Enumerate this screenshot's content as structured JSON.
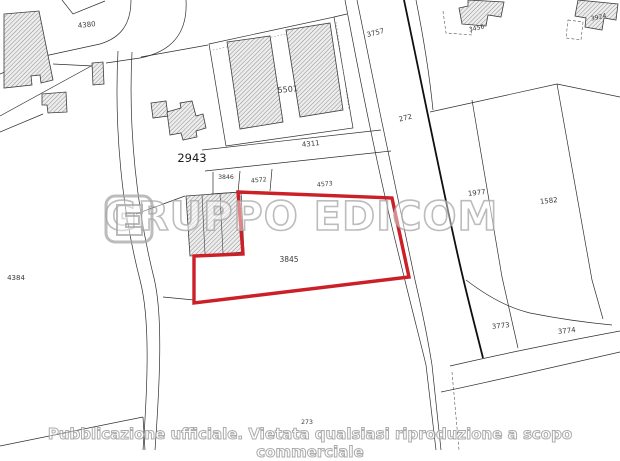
{
  "watermark": {
    "brand": "GRUPPO EDICOM",
    "logo_icon": "edicom-e-logo"
  },
  "disclaimer": "Pubblicazione ufficiale. Vietata qualsiasi riproduzione a scopo commerciale",
  "highlighted_parcel": {
    "number": "3845",
    "outline_color": "#cb2027"
  },
  "colors": {
    "map_line": "#2e2e2e",
    "road_dark_line": "#0f0f0f",
    "building_hatch": "#8f8f8f",
    "watermark_gray": "#a5a5a5"
  },
  "labels": [
    {
      "text": "4380"
    },
    {
      "text": "3757"
    },
    {
      "text": "3456"
    },
    {
      "text": "3924"
    },
    {
      "text": "5501"
    },
    {
      "text": "4311"
    },
    {
      "text": "2943"
    },
    {
      "text": "3846"
    },
    {
      "text": "4572"
    },
    {
      "text": "4573"
    },
    {
      "text": "272"
    },
    {
      "text": "1977"
    },
    {
      "text": "1582"
    },
    {
      "text": "4384"
    },
    {
      "text": "3845"
    },
    {
      "text": "3773"
    },
    {
      "text": "3774"
    },
    {
      "text": "273"
    }
  ]
}
